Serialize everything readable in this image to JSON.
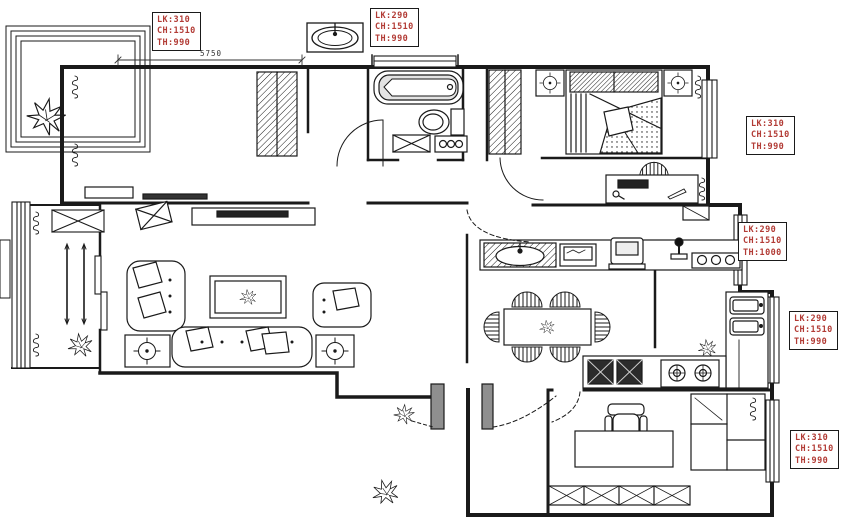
{
  "meta": {
    "drawing_type": "residential floor plan"
  },
  "dimension_labels": {
    "top_width": "5750"
  },
  "window_spec_labels": [
    {
      "position": "top-left",
      "l1": "LK:310",
      "l2": "CH:1510",
      "l3": "TH:990"
    },
    {
      "position": "top-middle",
      "l1": "LK:290",
      "l2": "CH:1510",
      "l3": "TH:990"
    },
    {
      "position": "right-upper",
      "l1": "LK:310",
      "l2": "CH:1510",
      "l3": "TH:990"
    },
    {
      "position": "right-middle",
      "l1": "LK:290",
      "l2": "CH:1510",
      "l3": "TH:1000"
    },
    {
      "position": "right-lower",
      "l1": "LK:290",
      "l2": "CH:1510",
      "l3": "TH:990"
    },
    {
      "position": "bottom-right",
      "l1": "LK:310",
      "l2": "CH:1510",
      "l3": "TH:990"
    }
  ],
  "colors": {
    "background": "#ffffff",
    "line": "#1a1a1a",
    "label_text": "#b23b35",
    "label_border": "#1a1a1a",
    "tv_fill": "#222222",
    "dark_counter_fill": "#2b2b2b"
  }
}
